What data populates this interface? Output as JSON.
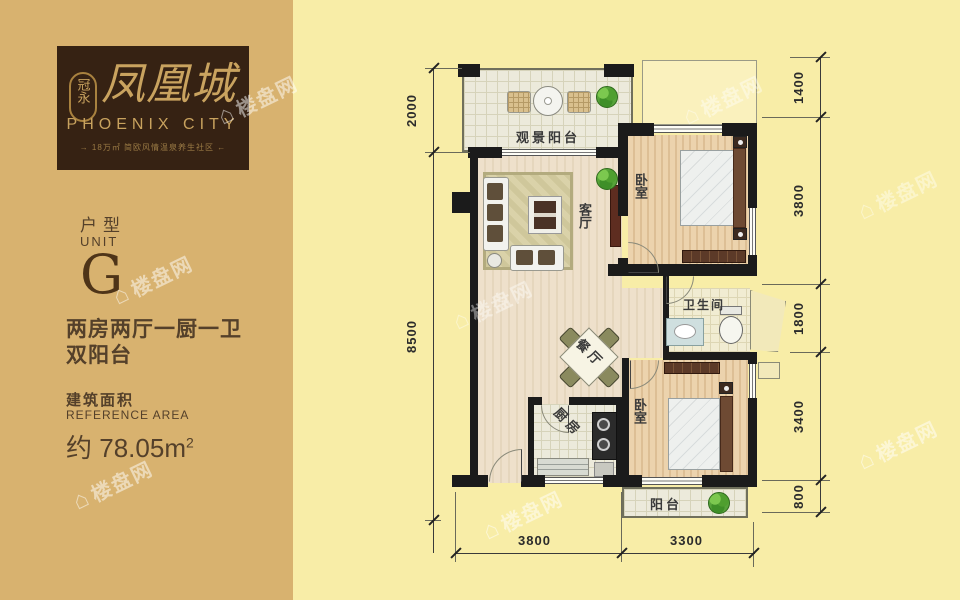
{
  "brand": {
    "seal": "冠永",
    "name": "凤凰城",
    "latin": "PHOENIX CITY",
    "tagline": "→ 18万㎡ 简欧风情温泉养生社区 ←"
  },
  "unit": {
    "type_cn": "户型",
    "type_en": "UNIT",
    "letter": "G",
    "desc_line1": "两房两厅一厨一卫",
    "desc_line2": "双阳台",
    "area_label_cn": "建筑面积",
    "area_label_en": "REFERENCE AREA",
    "area_prefix": "约",
    "area_value": "78.05m",
    "area_sup": "2"
  },
  "rooms": {
    "view_balcony": "观景阳台",
    "living": "客厅",
    "bedroom1": "卧室",
    "bath": "卫生间",
    "dining": "餐厅",
    "kitchen": "厨房",
    "bedroom2": "卧室",
    "balcony": "阳台"
  },
  "dims": {
    "left": [
      "2000",
      "8500"
    ],
    "right": [
      "1400",
      "3800",
      "1800",
      "3400",
      "800"
    ],
    "bottom": [
      "3800",
      "3300"
    ]
  },
  "watermark": {
    "icon": "⌂",
    "text": "楼盘网"
  },
  "colors": {
    "page_bg": "#f8eda7",
    "panel_bg": "#d8b26f",
    "logo_bg": "#362213",
    "logo_gold": "#c9a35f",
    "text_brown": "#54402a",
    "wall": "#1b1b1b"
  }
}
